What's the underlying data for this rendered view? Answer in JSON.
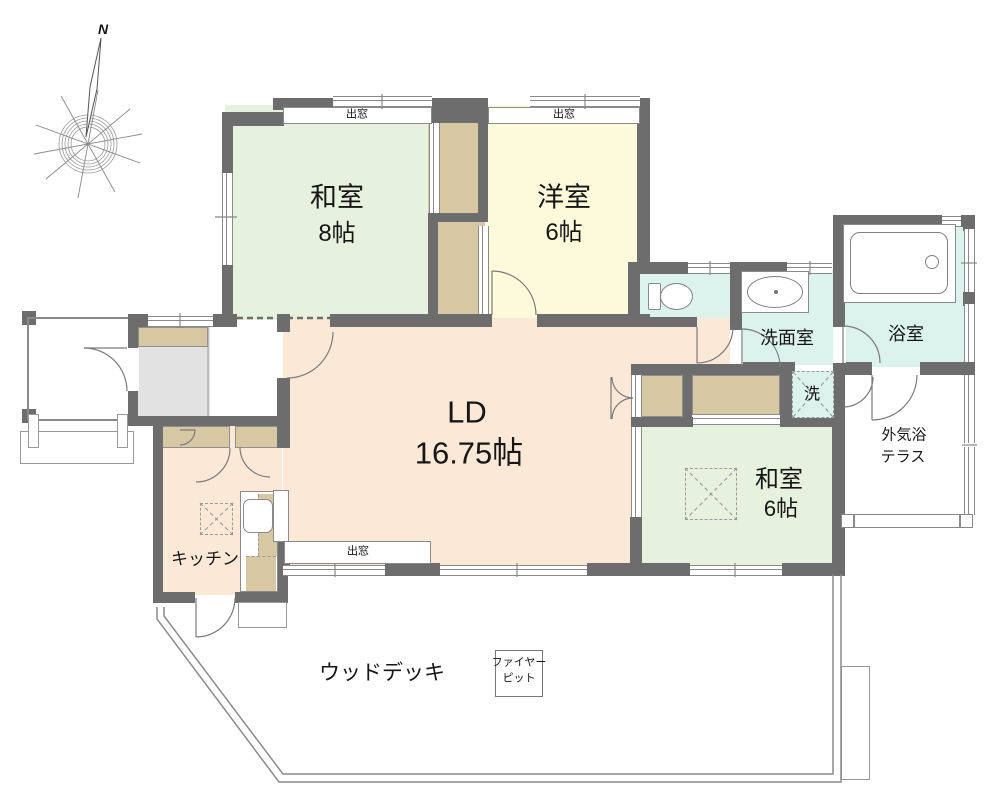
{
  "compass": {
    "north_label": "N"
  },
  "rooms": {
    "washitsu8": {
      "name": "和室",
      "size": "8帖"
    },
    "youshitsu6": {
      "name": "洋室",
      "size": "6帖"
    },
    "ld": {
      "name": "LD",
      "size": "16.75帖"
    },
    "washitsu6": {
      "name": "和室",
      "size": "6帖"
    },
    "senmen": {
      "name": "洗面室"
    },
    "bath": {
      "name": "浴室"
    },
    "kitchen": {
      "name": "キッチン"
    },
    "terrace": {
      "line1": "外気浴",
      "line2": "テラス"
    },
    "deck": {
      "name": "ウッドデッキ"
    },
    "laundry": {
      "name": "洗"
    },
    "firepit": {
      "line1": "ファイヤー",
      "line2": "ピット"
    }
  },
  "windows": {
    "bay_top_left": "出窓",
    "bay_top_right": "出窓",
    "bay_bottom": "出窓"
  },
  "colors": {
    "wall": "#6d6d6d",
    "line": "#8a8a8a",
    "tatami_green": "#e7f2de",
    "western_yellow": "#fcfadb",
    "ld_peach": "#fce8d6",
    "wet_cyan": "#dcf2ec",
    "closet_tan": "#d8c7a3",
    "entry_gray": "#e2e2e2"
  }
}
